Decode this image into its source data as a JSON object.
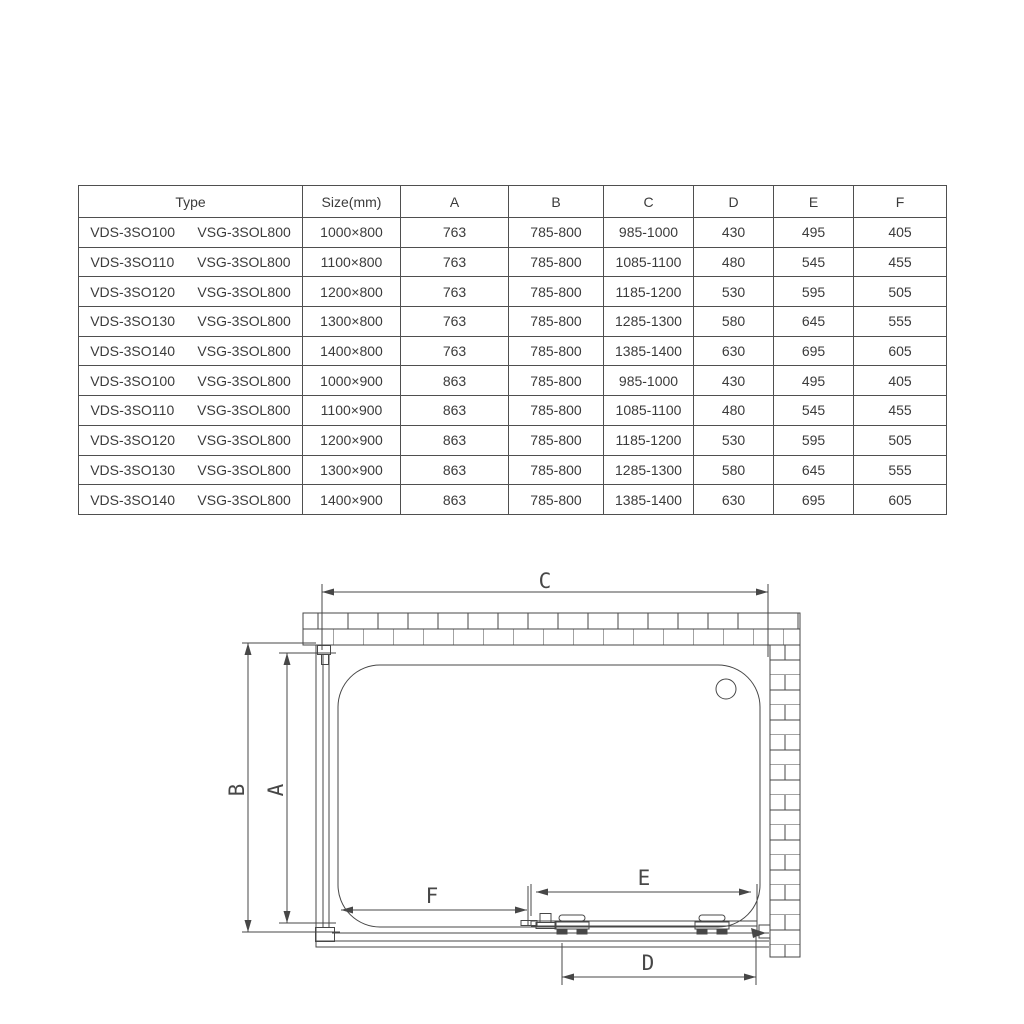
{
  "table": {
    "headers": [
      "Type",
      "Size(mm)",
      "A",
      "B",
      "C",
      "D",
      "E",
      "F"
    ],
    "rows": [
      {
        "type_a": "VDS-3SO100",
        "type_b": "VSG-3SOL800",
        "size": "1000×800",
        "a": "763",
        "b": "785-800",
        "c": "985-1000",
        "d": "430",
        "e": "495",
        "f": "405"
      },
      {
        "type_a": "VDS-3SO110",
        "type_b": "VSG-3SOL800",
        "size": "1100×800",
        "a": "763",
        "b": "785-800",
        "c": "1085-1100",
        "d": "480",
        "e": "545",
        "f": "455"
      },
      {
        "type_a": "VDS-3SO120",
        "type_b": "VSG-3SOL800",
        "size": "1200×800",
        "a": "763",
        "b": "785-800",
        "c": "1185-1200",
        "d": "530",
        "e": "595",
        "f": "505"
      },
      {
        "type_a": "VDS-3SO130",
        "type_b": "VSG-3SOL800",
        "size": "1300×800",
        "a": "763",
        "b": "785-800",
        "c": "1285-1300",
        "d": "580",
        "e": "645",
        "f": "555"
      },
      {
        "type_a": "VDS-3SO140",
        "type_b": "VSG-3SOL800",
        "size": "1400×800",
        "a": "763",
        "b": "785-800",
        "c": "1385-1400",
        "d": "630",
        "e": "695",
        "f": "605"
      },
      {
        "type_a": "VDS-3SO100",
        "type_b": "VSG-3SOL800",
        "size": "1000×900",
        "a": "863",
        "b": "785-800",
        "c": "985-1000",
        "d": "430",
        "e": "495",
        "f": "405"
      },
      {
        "type_a": "VDS-3SO110",
        "type_b": "VSG-3SOL800",
        "size": "1100×900",
        "a": "863",
        "b": "785-800",
        "c": "1085-1100",
        "d": "480",
        "e": "545",
        "f": "455"
      },
      {
        "type_a": "VDS-3SO120",
        "type_b": "VSG-3SOL800",
        "size": "1200×900",
        "a": "863",
        "b": "785-800",
        "c": "1185-1200",
        "d": "530",
        "e": "595",
        "f": "505"
      },
      {
        "type_a": "VDS-3SO130",
        "type_b": "VSG-3SOL800",
        "size": "1300×900",
        "a": "863",
        "b": "785-800",
        "c": "1285-1300",
        "d": "580",
        "e": "645",
        "f": "555"
      },
      {
        "type_a": "VDS-3SO140",
        "type_b": "VSG-3SOL800",
        "size": "1400×900",
        "a": "863",
        "b": "785-800",
        "c": "1385-1400",
        "d": "630",
        "e": "695",
        "f": "605"
      }
    ]
  },
  "diagram": {
    "labels": {
      "a": "A",
      "b": "B",
      "c": "C",
      "d": "D",
      "e": "E",
      "f": "F"
    }
  },
  "colors": {
    "line": "#474747",
    "text": "#3b3b3b",
    "background": "#ffffff"
  }
}
